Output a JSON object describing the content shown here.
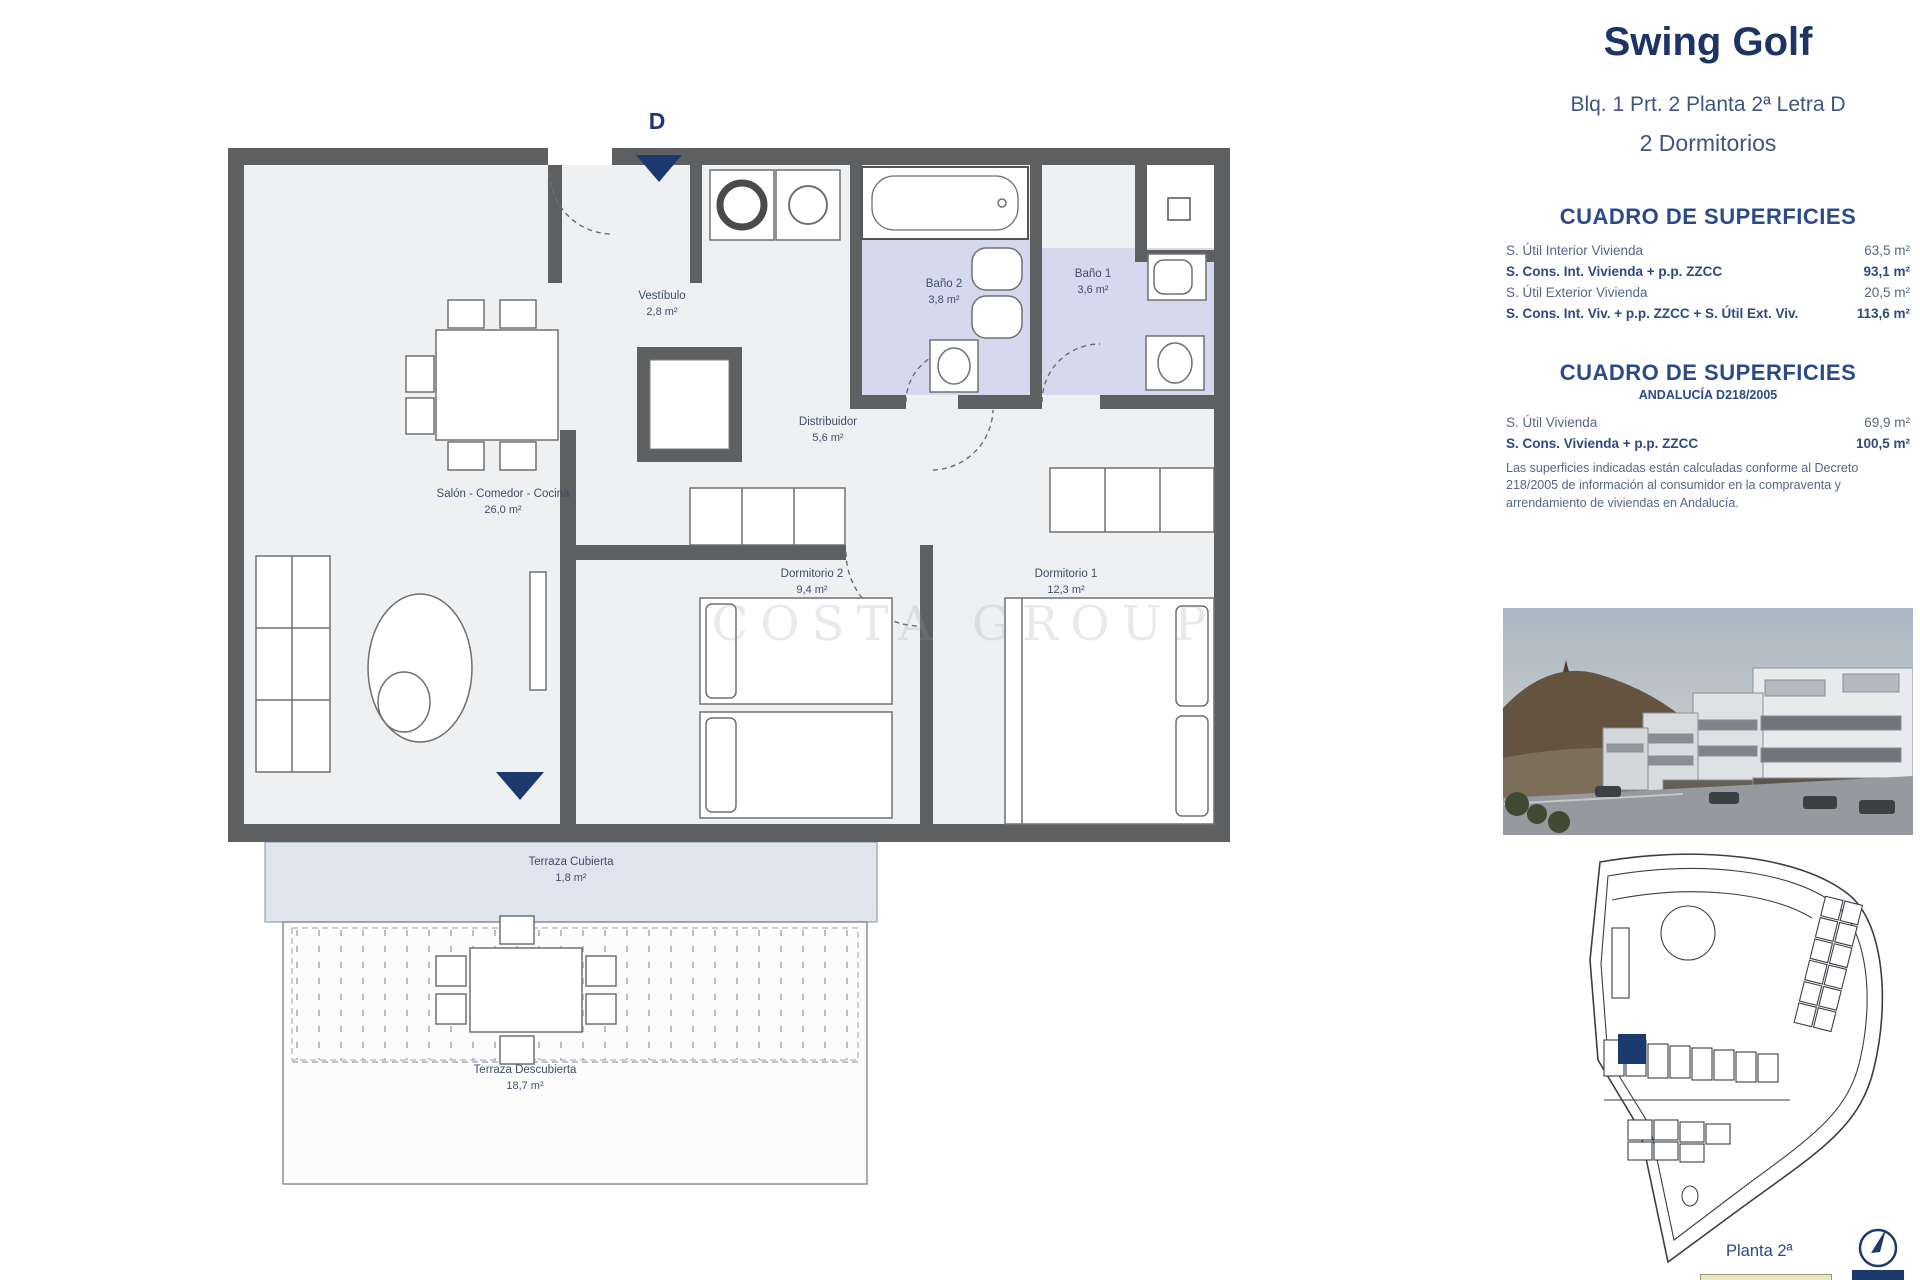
{
  "floorplan": {
    "entrance_letter": "D",
    "watermark": "COSTA GROUP",
    "rooms": [
      {
        "name": "Vestíbulo",
        "area": "2,8 m²"
      },
      {
        "name": "Baño 2",
        "area": "3,8 m²"
      },
      {
        "name": "Baño 1",
        "area": "3,6 m²"
      },
      {
        "name": "Distribuidor",
        "area": "5,6 m²"
      },
      {
        "name": "Salón - Comedor - Cocina",
        "area": "26,0 m²"
      },
      {
        "name": "Dormitorio 2",
        "area": "9,4 m²"
      },
      {
        "name": "Dormitorio 1",
        "area": "12,3 m²"
      },
      {
        "name": "Terraza Cubierta",
        "area": "1,8 m²"
      },
      {
        "name": "Terraza Descubierta",
        "area": "18,7 m²"
      }
    ]
  },
  "panel": {
    "title": "Swing Golf",
    "subtitle": "Blq. 1 Prt. 2 Planta 2ª Letra D",
    "bedrooms": "2 Dormitorios",
    "table1": {
      "heading": "CUADRO DE SUPERFICIES",
      "rows": [
        {
          "label": "S. Útil Interior Vivienda",
          "value": "63,5 m²"
        },
        {
          "label": "S. Cons. Int. Vivienda + p.p. ZZCC",
          "value": "93,1 m²"
        },
        {
          "label": "S. Útil Exterior Vivienda",
          "value": "20,5 m²"
        },
        {
          "label": "S. Cons. Int. Viv. + p.p. ZZCC + S. Útil Ext. Viv.",
          "value": "113,6 m²"
        }
      ]
    },
    "table2": {
      "heading": "CUADRO DE SUPERFICIES",
      "subheading": "ANDALUCÍA D218/2005",
      "rows": [
        {
          "label": "S. Útil Vivienda",
          "value": "69,9 m²"
        },
        {
          "label": "S. Cons. Vivienda + p.p. ZZCC",
          "value": "100,5 m²"
        }
      ]
    },
    "legal": "Las superficies indicadas están calculadas conforme al Decreto 218/2005 de información al consumidor en la compraventa y arrendamiento de viviendas en Andalucía.",
    "siteplan_caption": "Planta 2ª"
  },
  "colors": {
    "accent_navy": "#1c3a6e",
    "wall_gray": "#5d5f61",
    "bathroom_lavender": "#d6d8ee",
    "terrace_band": "#e0e4ef",
    "interior_gray": "#eef0f1"
  }
}
